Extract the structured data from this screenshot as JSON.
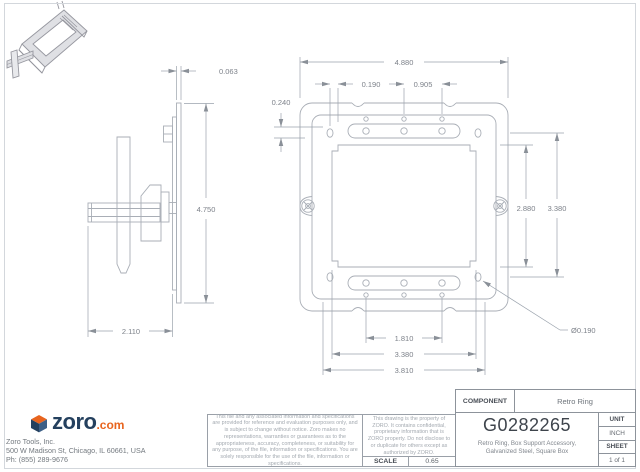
{
  "drawing": {
    "views": {
      "side": {
        "dims": {
          "thickness": "0.063",
          "height": "4.750",
          "depth": "2.110"
        }
      },
      "front": {
        "dims": {
          "overall_width": "4.880",
          "hole_offset": "0.190",
          "hole_pitch": "0.905",
          "edge_offset": "0.240",
          "opening_height": "2.880",
          "ring_height": "3.380",
          "slot_span": "1.810",
          "opening_width": "3.380",
          "hole_span": "3.810",
          "hole_diameter": "Ø0.190"
        }
      }
    }
  },
  "footer": {
    "logo": {
      "brand": "zoro",
      "suffix": ".com"
    },
    "company_lines": [
      "Zoro Tools, Inc.",
      "500 W Madison St, Chicago, IL 60661, USA",
      "Ph: (855) 289-9676"
    ],
    "disclaimer_file": "This file and any associated information and specifications are provided for reference and evaluation purposes only, and is subject to change without notice. Zoro makes no representations, warranties or guarantees as to the appropriateness, accuracy, completeness, or suitability for any purpose, of the file, information or specifications. You are solely responsible for the use of the file, information or specifications.",
    "disclaimer_property": "This drawing is the property of ZORO. It contains confidential, proprietary information that is ZORO property. Do not disclose to or duplicate for others except as authorized by ZORO.",
    "scale": {
      "label": "SCALE",
      "value": "0.65"
    },
    "title_block": {
      "component_label": "COMPONENT",
      "component_value": "Retro Ring",
      "part_number": "G0282265",
      "description_line1": "Retro Ring, Box Support Accessory,",
      "description_line2": "Galvanized Steel, Square Box",
      "unit_label": "UNIT",
      "unit_value": "INCH",
      "sheet_label": "SHEET",
      "sheet_value": "1 of 1"
    }
  }
}
